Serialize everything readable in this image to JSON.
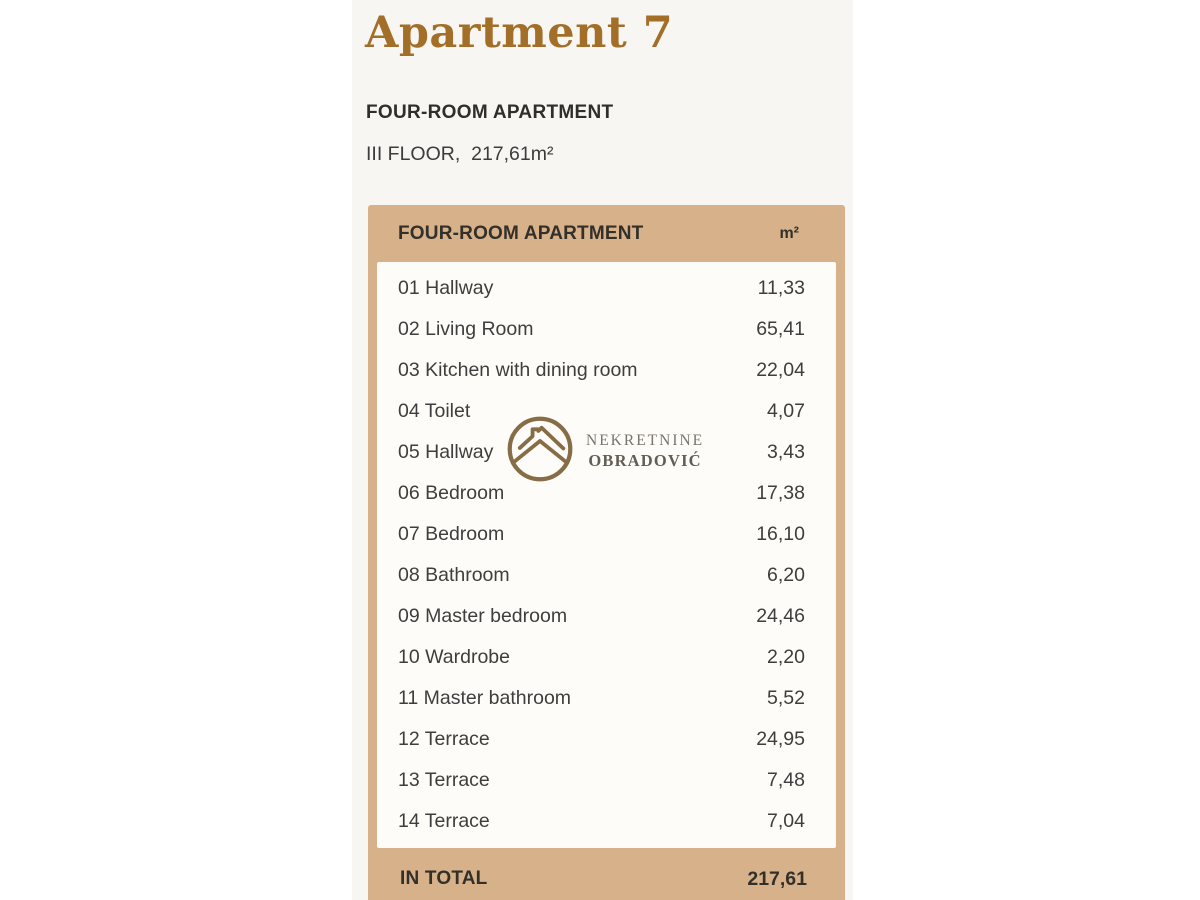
{
  "page": {
    "title": "Apartment 7",
    "subtitle": "FOUR-ROOM APARTMENT",
    "floor_line": "III FLOOR,  217,61m²"
  },
  "table": {
    "header": {
      "label": "FOUR-ROOM APARTMENT",
      "unit": "m²"
    },
    "rows": [
      {
        "label": "01 Hallway",
        "area": "11,33"
      },
      {
        "label": "02 Living Room",
        "area": "65,41"
      },
      {
        "label": "03 Kitchen with dining room",
        "area": "22,04"
      },
      {
        "label": "04 Toilet",
        "area": "4,07"
      },
      {
        "label": "05 Hallway",
        "area": "3,43"
      },
      {
        "label": "06 Bedroom",
        "area": "17,38"
      },
      {
        "label": "07 Bedroom",
        "area": "16,10"
      },
      {
        "label": "08 Bathroom",
        "area": "6,20"
      },
      {
        "label": "09 Master bedroom",
        "area": "24,46"
      },
      {
        "label": "10 Wardrobe",
        "area": "2,20"
      },
      {
        "label": "11 Master bathroom",
        "area": "5,52"
      },
      {
        "label": "12 Terrace",
        "area": "24,95"
      },
      {
        "label": "13 Terrace",
        "area": "7,48"
      },
      {
        "label": "14 Terrace",
        "area": "7,04"
      }
    ],
    "total": {
      "label": "IN TOTAL",
      "value": "217,61"
    }
  },
  "watermark": {
    "line1": "NEKRETNINE",
    "line2": "OBRADOVIĆ",
    "icon": "house-in-circle-icon"
  },
  "colors": {
    "accent_tan": "#d6b189",
    "panel_white": "#fdfcf8",
    "content_bg": "#f7f6f3",
    "title_bronze": "#a36f28",
    "logo_brown": "#7c6136",
    "text_dark": "#3e3e3e"
  }
}
